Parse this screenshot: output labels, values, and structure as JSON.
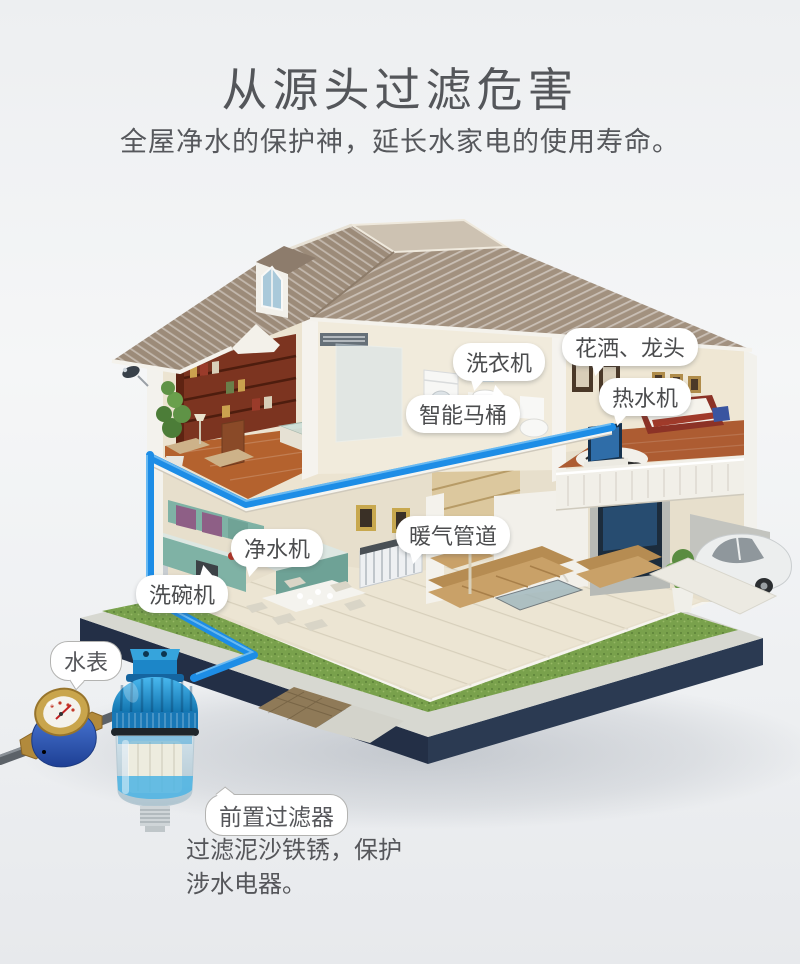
{
  "header": {
    "title": "从源头过滤危害",
    "subtitle": "全屋净水的保护神，延长水家电的使用寿命。"
  },
  "callouts": [
    {
      "id": "washing-machine",
      "label": "洗衣机"
    },
    {
      "id": "shower-faucet",
      "label": "花洒、龙头"
    },
    {
      "id": "water-heater",
      "label": "热水机"
    },
    {
      "id": "smart-toilet",
      "label": "智能马桶"
    },
    {
      "id": "water-purifier",
      "label": "净水机"
    },
    {
      "id": "heating-pipes",
      "label": "暖气管道"
    },
    {
      "id": "dishwasher",
      "label": "洗碗机"
    },
    {
      "id": "water-meter",
      "label": "水表"
    },
    {
      "id": "prefilter",
      "label": "前置过滤器"
    }
  ],
  "prefilter_note": {
    "line1": "过滤泥沙铁锈，保护",
    "line2": "涉水电器。"
  },
  "colors": {
    "pipe_blue": "#1d8de6",
    "text_gray": "#54565a",
    "lawn_green": "#79a14c",
    "base_navy": "#25324a",
    "roof_taupe": "#a2917f",
    "filter_cap_blue": "#2f9fd8",
    "meter_blue": "#2e55b0"
  }
}
